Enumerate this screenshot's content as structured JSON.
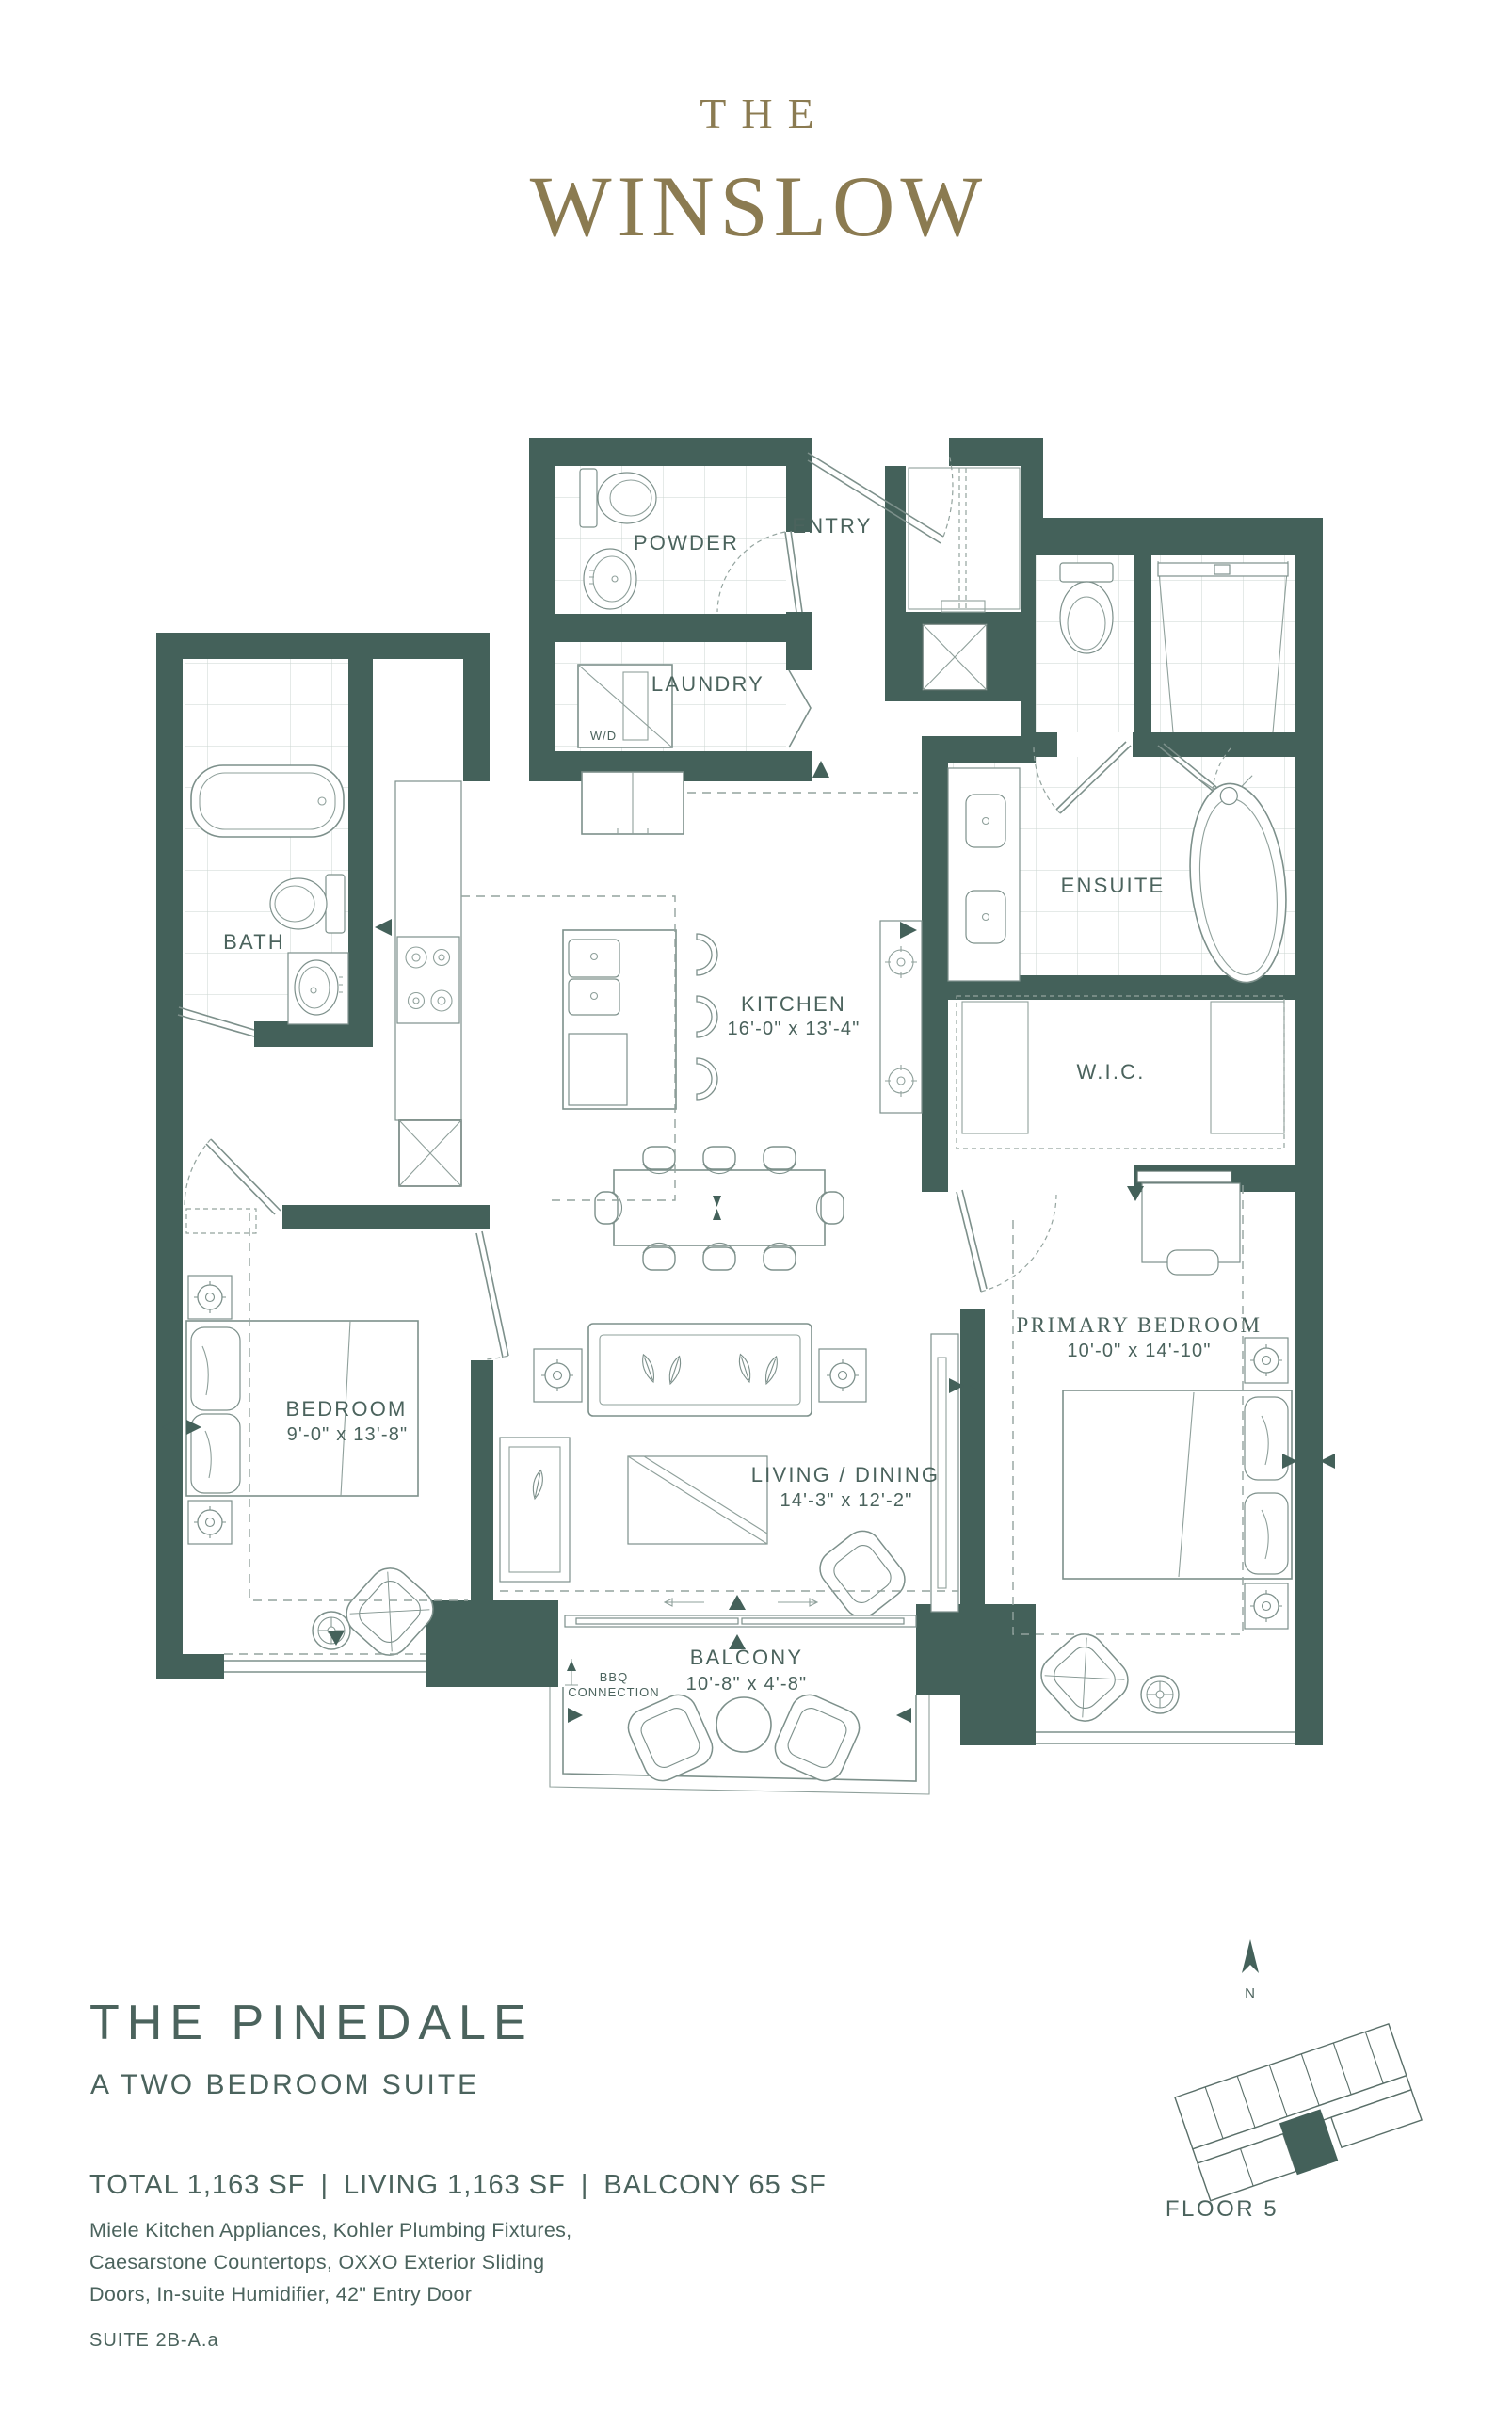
{
  "brand": {
    "prefix": "THE",
    "name": "WINSLOW"
  },
  "plan": {
    "rooms": {
      "powder": {
        "label": "POWDER"
      },
      "entry": {
        "label": "ENTRY"
      },
      "laundry": {
        "label": "LAUNDRY",
        "appliance": "W/D"
      },
      "bath": {
        "label": "BATH"
      },
      "kitchen": {
        "label": "KITCHEN",
        "dims": "16'-0\" x 13'-4\""
      },
      "ensuite": {
        "label": "ENSUITE"
      },
      "wic": {
        "label": "W.I.C."
      },
      "bedroom": {
        "label": "BEDROOM",
        "dims": "9'-0\" x 13'-8\""
      },
      "primary": {
        "label": "PRIMARY BEDROOM",
        "dims": "10'-0\" x 14'-10\""
      },
      "living": {
        "label": "LIVING / DINING",
        "dims": "14'-3\" x 12'-2\""
      },
      "balcony": {
        "label": "BALCONY",
        "dims": "10'-8\" x 4'-8\""
      }
    },
    "annotations": {
      "bbq_line1": "BBQ",
      "bbq_line2": "CONNECTION"
    }
  },
  "footer": {
    "suite_name": "THE PINEDALE",
    "suite_subtitle": "A TWO BEDROOM SUITE",
    "areas": {
      "total": "TOTAL 1,163 SF",
      "living": "LIVING 1,163 SF",
      "balcony": "BALCONY 65 SF",
      "divider": "|"
    },
    "features": [
      "Miele Kitchen Appliances, Kohler Plumbing Fixtures,",
      "Caesarstone Countertops, OXXO Exterior Sliding",
      "Doors, In-suite Humidifier, 42\" Entry Door"
    ],
    "suite_code": "SUITE 2B-A.a"
  },
  "keyplan": {
    "floor": "FLOOR 5",
    "north": "N"
  },
  "colors": {
    "wall": "#44615A",
    "text": "#4B635D",
    "gold": "#8B7B51",
    "line": "#7D908B"
  }
}
